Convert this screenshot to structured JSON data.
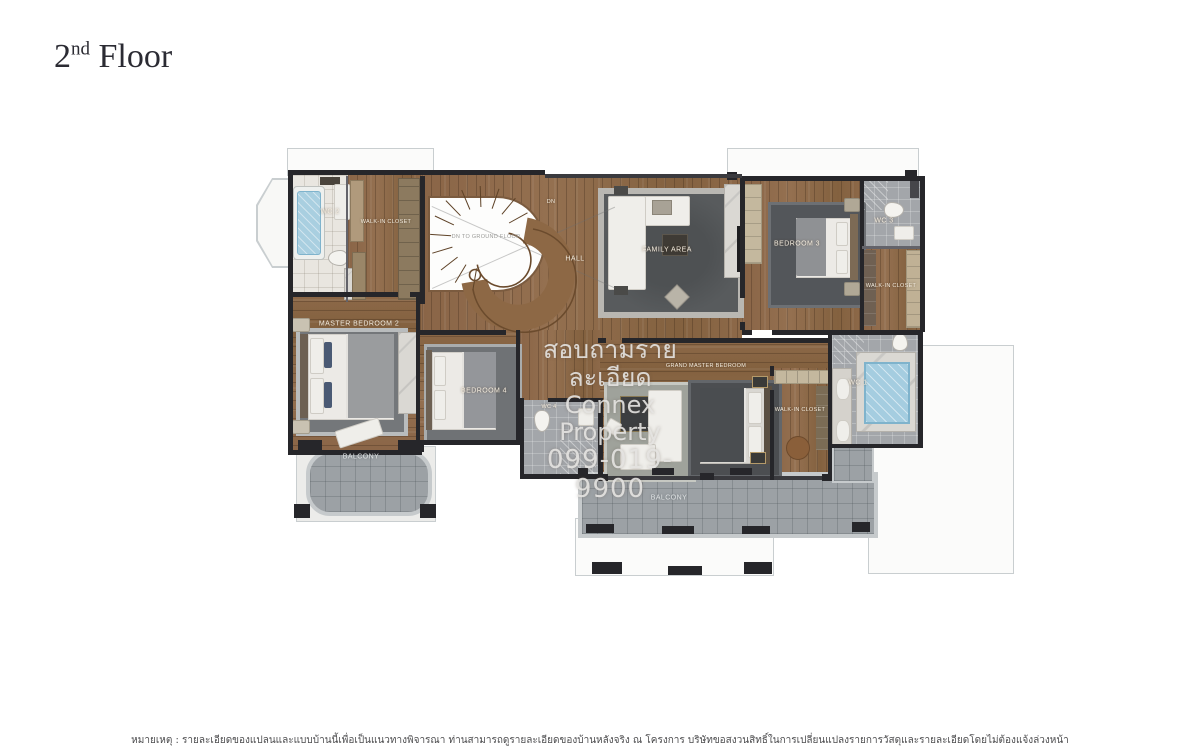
{
  "title": {
    "floor_number": "2",
    "ordinal_suffix": "nd",
    "floor_word": "Floor"
  },
  "rooms": {
    "wc1": "WC 1",
    "wc2": "WC 2",
    "wc3": "WC 3",
    "wc4": "WC 4",
    "walk_in_closet_top": "WALK-IN CLOSET",
    "walk_in_closet_right": "WALK-IN CLOSET",
    "walk_in_closet_master": "WALK-IN CLOSET",
    "hall": "HALL",
    "dn": "DN",
    "stair_note": "DN TO GROUND FLOOR",
    "family_area": "FAMILY AREA",
    "bedroom_3": "BEDROOM 3",
    "bedroom_4": "BEDROOM 4",
    "master_bedroom_2": "MASTER BEDROOM 2",
    "grand_master_bedroom": "GRAND MASTER BEDROOM",
    "balcony_left": "BALCONY",
    "balcony_main": "BALCONY"
  },
  "watermark": {
    "line1": "สอบถามรายละเอียด",
    "line2": "Connex Property",
    "line3": "099-019-9900"
  },
  "footnote": {
    "text": "หมายเหตุ : รายละเอียดของแปลนและแบบบ้านนี้เพื่อเป็นแนวทางพิจารณา ท่านสามารถดูรายละเอียดของบ้านหลังจริง ณ โครงการ บริษัทขอสงวนสิทธิ์ในการเปลี่ยนแปลงรายการวัสดุและรายละเอียดโดยไม่ต้องแจ้งล่วงหน้า"
  },
  "colors": {
    "wall": "#26262a",
    "wood": "#8d6949",
    "tile": "#a3a6aa",
    "water": "#a5cde0",
    "rug": "#55585b",
    "stone": "#9ca1a5"
  }
}
